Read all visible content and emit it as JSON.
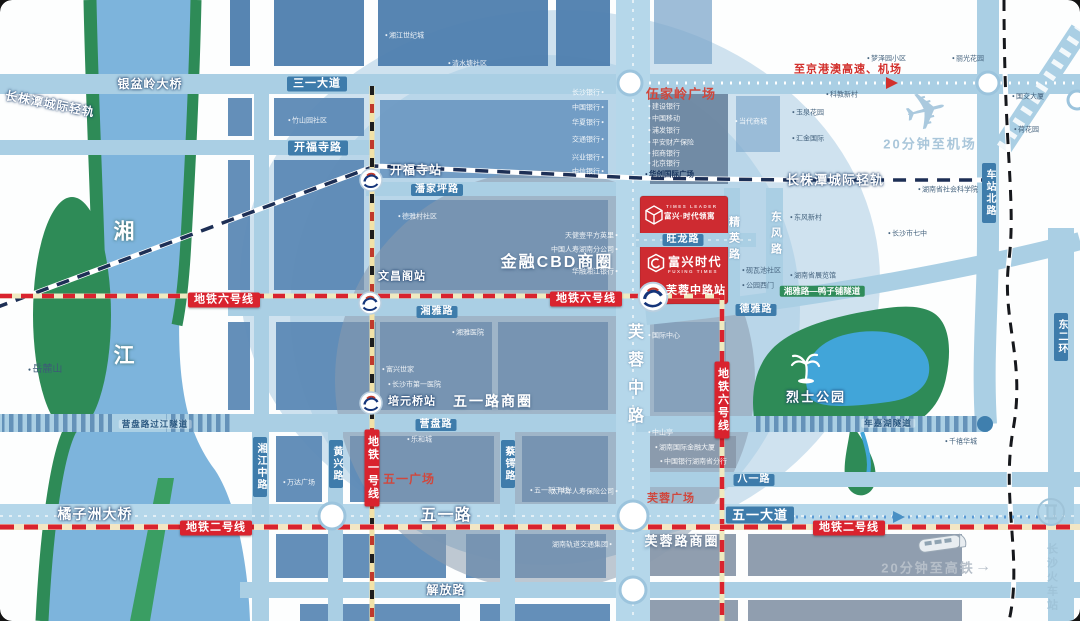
{
  "colors": {
    "metro_red": "#d9232e",
    "road_label_blue": "#3e7cab",
    "project_red": "#ce2b31",
    "river_blue": "#7db4dc",
    "park_green": "#2e8b57",
    "accent_red_text": "#d0473d"
  },
  "project": {
    "logo_en": "TIMES LEADER",
    "logo_name": "富兴·时代领寓",
    "name": "富兴时代",
    "name_en": "FUXING TIMES",
    "station": "芙蓉中路站"
  },
  "river": {
    "char1": "湘",
    "char2": "江"
  },
  "mountain": "岳麓山",
  "metro": {
    "line1": "地铁一号线",
    "line2": "地铁二号线",
    "line6": "地铁六号线"
  },
  "intercity": {
    "label": "长株潭城际轻轨"
  },
  "stations": {
    "kaifusi": "开福寺站",
    "wenchangge": "文昌阁站",
    "peiyuanqiao": "培元桥站"
  },
  "roads": {
    "yinpenling_bridge": "银盆岭大桥",
    "sanyi": "三一大道",
    "kaifusi": "开福寺路",
    "panjiaping": "潘家坪路",
    "xiangya": "湘雅路",
    "yingpan": "营盘路",
    "yingpan_tunnel": "营盘路过江隧道",
    "juzizhou_bridge": "橘子洲大桥",
    "wuyi": "五一路",
    "wuyi_ave": "五一大道",
    "jiefang": "解放路",
    "bayi": "八一路",
    "deya": "德雅路",
    "wanglong": "旺龙路",
    "xiangjiang_mid": "湘江中路",
    "huangxing": "黄兴路",
    "caie": "蔡锷路",
    "furong_mid": "芙蓉中路",
    "jingying": "精英路",
    "dongfeng": "东风路",
    "chezhan_north": "车站北路",
    "east_ring2": "东二环",
    "nianjiahu_tunnel": "年嘉湖隧道",
    "yazipu_tunnel": "湘雅路—鸭子铺隧道"
  },
  "districts": {
    "cbd": "金融CBD商圈",
    "wuyilu": "五一路商圈",
    "furonglu": "芙蓉路商圈",
    "wujialing": "伍家岭广场",
    "wuyi_square": "五一广场",
    "furong_square": "芙蓉广场"
  },
  "landmarks": {
    "martyrs_park": "烈士公园",
    "railway_station": "长沙火车站"
  },
  "callouts": {
    "highway": "至京港澳高速、机场",
    "airport": "20分钟至机场",
    "hsr": "20分钟至高铁",
    "hsr_arrow": "→"
  },
  "pois": [
    {
      "t": "竹山园社区"
    },
    {
      "t": "湘江世纪城"
    },
    {
      "t": "清水塘社区"
    },
    {
      "t": "德雅村社区"
    },
    {
      "t": "长沙银行"
    },
    {
      "t": "中国银行"
    },
    {
      "t": "华夏银行"
    },
    {
      "t": "交通银行"
    },
    {
      "t": "兴业银行"
    },
    {
      "t": "中信银行"
    },
    {
      "t": "天健壹平方英里"
    },
    {
      "t": "中国人寿湖南分公司"
    },
    {
      "t": "华融湘江银行"
    },
    {
      "t": "湘雅医院"
    },
    {
      "t": "富兴世家"
    },
    {
      "t": "长沙市第一医院"
    },
    {
      "t": "万达广场"
    },
    {
      "t": "乐和城"
    },
    {
      "t": "五一新干线"
    },
    {
      "t": "国际中心"
    },
    {
      "t": "建设银行"
    },
    {
      "t": "中国移动"
    },
    {
      "t": "浦发银行"
    },
    {
      "t": "平安财产保险"
    },
    {
      "t": "招商银行"
    },
    {
      "t": "北京银行"
    },
    {
      "t": "华创国际广场"
    },
    {
      "t": "当代商城"
    },
    {
      "t": "玉泉花园"
    },
    {
      "t": "汇金国际"
    },
    {
      "t": "梦泽园小区"
    },
    {
      "t": "丽光花园"
    },
    {
      "t": "科教新村"
    },
    {
      "t": "国交大厦"
    },
    {
      "t": "荷花园"
    },
    {
      "t": "湖南省社会科学院"
    },
    {
      "t": "东风新村"
    },
    {
      "t": "长沙市七中"
    },
    {
      "t": "湖南省展览馆"
    },
    {
      "t": "砚瓦池社区"
    },
    {
      "t": "公园西门"
    },
    {
      "t": "千禧华城"
    },
    {
      "t": "中山亭"
    },
    {
      "t": "湖南国际金融大厦"
    },
    {
      "t": "中国银行湖南省分行"
    },
    {
      "t": "太平洋人寿保险公司"
    },
    {
      "t": "湖南轨道交通集团"
    }
  ]
}
